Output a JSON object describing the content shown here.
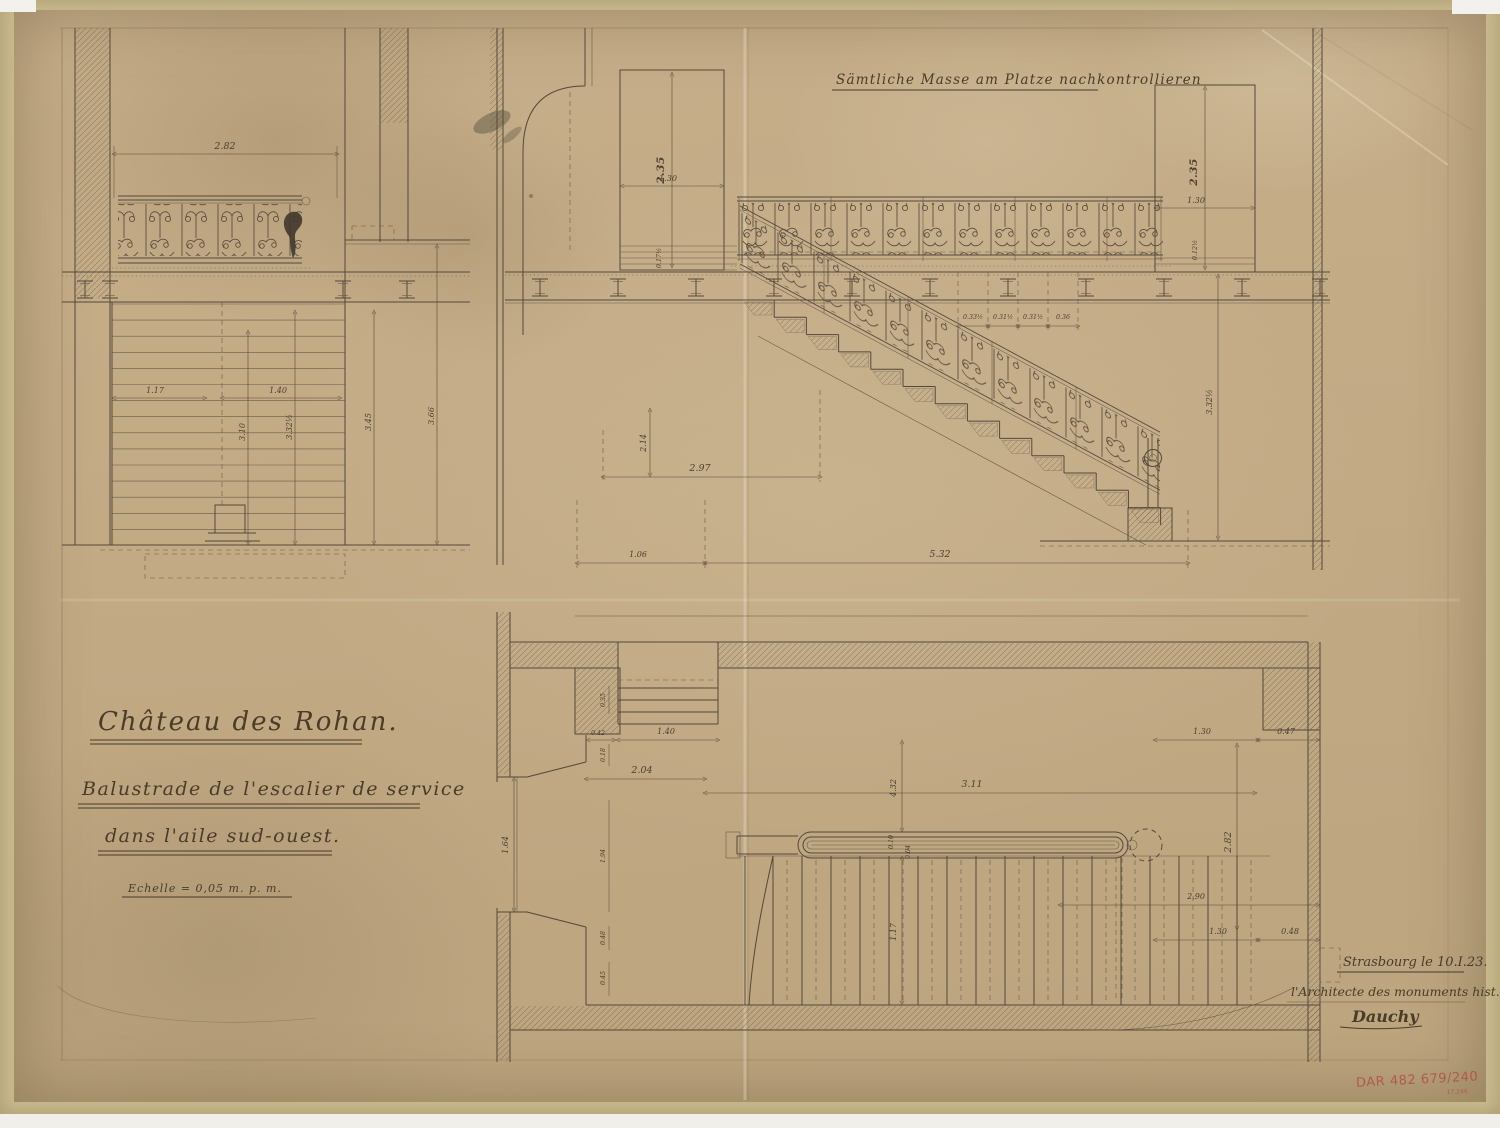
{
  "annotations": {
    "top_note": "Sämtliche Masse am Platze nachkontrollieren",
    "title": {
      "line1": "Château des Rohan.",
      "line2": "Balustrade de l'escalier de service",
      "line3": "dans l'aile sud-ouest."
    },
    "scale": "Echelle = 0,05 m. p. m.",
    "place_date": "Strasbourg le 10.I.23.",
    "architect": "l'Architecte des monuments hist.",
    "signature": "Dauchy",
    "stamp": {
      "text": "DAR 482 679/240",
      "small_text": "17.246"
    }
  },
  "views": {
    "balcony": {
      "label": "balcony balustrade elevation",
      "dims": {
        "width": "2.82",
        "tread_width": "1.17",
        "landing": "1.40",
        "h1": "3.10",
        "h2": "3.32½",
        "h3": "3.45",
        "h4": "3.66"
      }
    },
    "elevation": {
      "label": "staircase elevation with wrought-iron balustrade",
      "dims": {
        "door_left_h": "2.35",
        "door_left_w": "1.30",
        "door_left_step": "0.17½",
        "s1": "0.33½",
        "s2": "0.31½",
        "s3": "0.31½",
        "s4": "0.36",
        "run_top": "2.97",
        "rise": "2.14",
        "right_h": "3.32½",
        "door_right_h": "2.35",
        "door_right_w": "1.30",
        "sill": "0.12½",
        "landing_b": "1.06",
        "run_b": "5.32"
      }
    },
    "plan": {
      "label": "staircase plan",
      "dims": {
        "step": "0.35",
        "jamb": "0.42",
        "door": "1.40",
        "recess": "2.04",
        "run": "3.11",
        "depth": "4.32",
        "tread": "1.17",
        "rail1": "0.10",
        "rail2": "0.04",
        "r_top1": "1.30",
        "r_top2": "0.47",
        "r_side": "2.82",
        "r_w": "2.90",
        "r_bot1": "1.30",
        "r_bot2": "0.48",
        "window": "1.64",
        "l2": "0.18",
        "l3": "1.94",
        "l4": "0.48",
        "l5": "0.45"
      }
    }
  },
  "colors": {
    "paper": "#c2aa85",
    "mat": "#c9ba8e",
    "ink": "#54483a",
    "ink_strong": "#3f362a",
    "stamp_red": "#b14b42"
  }
}
